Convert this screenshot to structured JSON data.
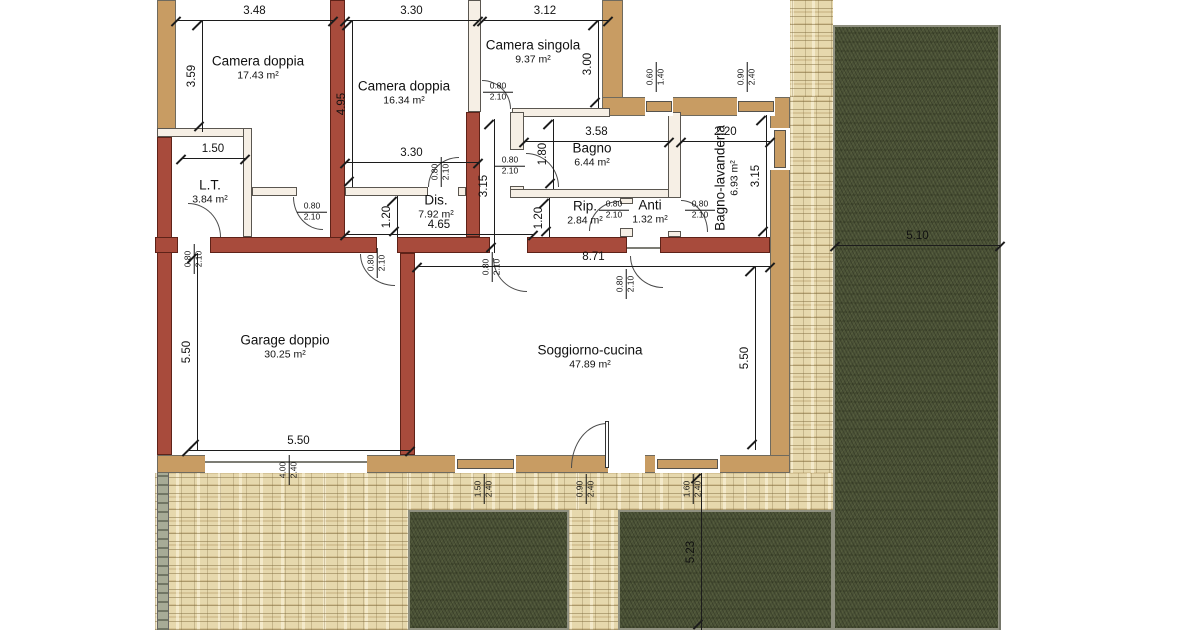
{
  "rooms": [
    {
      "name": "Camera doppia",
      "area": "17.43 m²"
    },
    {
      "name": "Camera doppia",
      "area": "16.34 m²"
    },
    {
      "name": "Camera singola",
      "area": "9.37 m²"
    },
    {
      "name": "L.T.",
      "area": "3.84 m²"
    },
    {
      "name": "Dis.",
      "area": "7.92 m²"
    },
    {
      "name": "Bagno",
      "area": "6.44 m²"
    },
    {
      "name": "Rip.",
      "area": "2.84 m²"
    },
    {
      "name": "Anti",
      "area": "1.32 m²"
    },
    {
      "name": "Bagno-lavanderia",
      "area": "6.93 m²"
    },
    {
      "name": "Garage doppio",
      "area": "30.25 m²"
    },
    {
      "name": "Soggiorno-cucina",
      "area": "47.89 m²"
    }
  ],
  "dimensions": {
    "cam1_width": "3.48",
    "cam2_width": "3.30",
    "singola_width": "3.12",
    "cam1_depth": "3.59",
    "cam2_depth": "4.95",
    "singola_depth": "3.00",
    "lt_width": "1.50",
    "cam2_width_b": "3.30",
    "bagno_width": "3.58",
    "lavanderia_width": "2.20",
    "bagno_depth": "1.80",
    "corridor_depth": "3.15",
    "lavanderia_depth": "3.15",
    "niche_depth": "1.20",
    "rip_depth": "1.20",
    "dis_length": "4.65",
    "soggiorno_width": "8.71",
    "garage_depth": "5.50",
    "garage_width": "5.50",
    "soggiorno_depth": "5.50",
    "garden_east": "5.10",
    "garden_south": "5.23"
  },
  "openings": {
    "door": {
      "w": "0.80",
      "h": "2.10"
    },
    "window_small": {
      "w": "0.60",
      "h": "1.40"
    },
    "window_090": {
      "w": "0.90",
      "h": "2.40"
    },
    "garage_door": {
      "w": "4.00",
      "h": "2.40"
    },
    "window_150": {
      "w": "1.50",
      "h": "2.40"
    },
    "window_160": {
      "w": "1.60",
      "h": "2.40"
    }
  },
  "colors": {
    "load_bearing_wall": "#a84b3c",
    "exterior_wall": "#c89c63",
    "partition_wall": "#f6efe5",
    "stone_paving": "#e6d8ad",
    "grass": "#4c5338",
    "dimension_line": "#1c1c1c"
  }
}
